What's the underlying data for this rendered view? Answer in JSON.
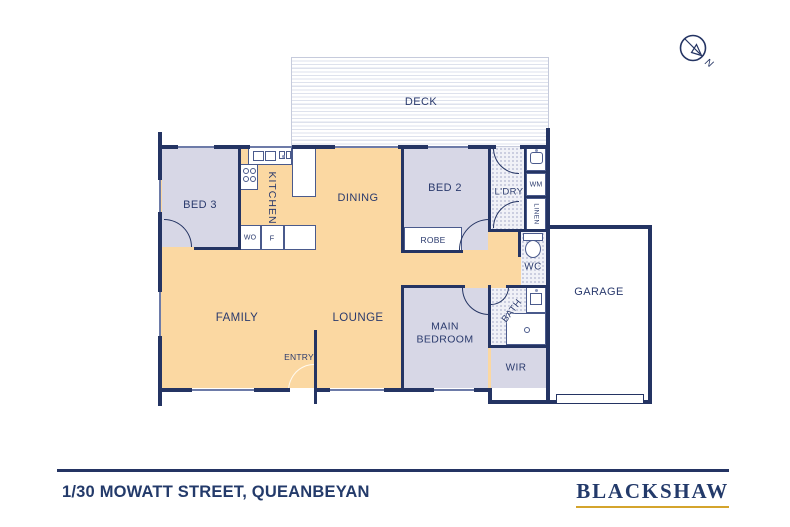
{
  "compass": {
    "north_label": "N"
  },
  "rooms": {
    "deck": "DECK",
    "bed3": "BED 3",
    "kitchen": "KITCHEN",
    "dining": "DINING",
    "bed2": "BED 2",
    "laundry": "L'DRY",
    "wm": "WM",
    "linen": "LINEN",
    "robe": "ROBE",
    "wall_oven": "WO",
    "fridge": "F",
    "wc": "WC",
    "bath": "BATH",
    "family": "FAMILY",
    "lounge": "LOUNGE",
    "entry": "ENTRY",
    "main_bedroom_line1": "MAIN",
    "main_bedroom_line2": "BEDROOM",
    "wir": "WIR",
    "garage": "GARAGE"
  },
  "footer": {
    "address": "1/30 MOWATT STREET, QUEANBEYAN",
    "brand": "BLACKSHAW"
  },
  "colors": {
    "navy": "#243463",
    "floor_orange": "#fbd8a2",
    "floor_lavender": "#d7d7e6",
    "wet_area": "#f0f1f7",
    "gold": "#d4a42c"
  }
}
